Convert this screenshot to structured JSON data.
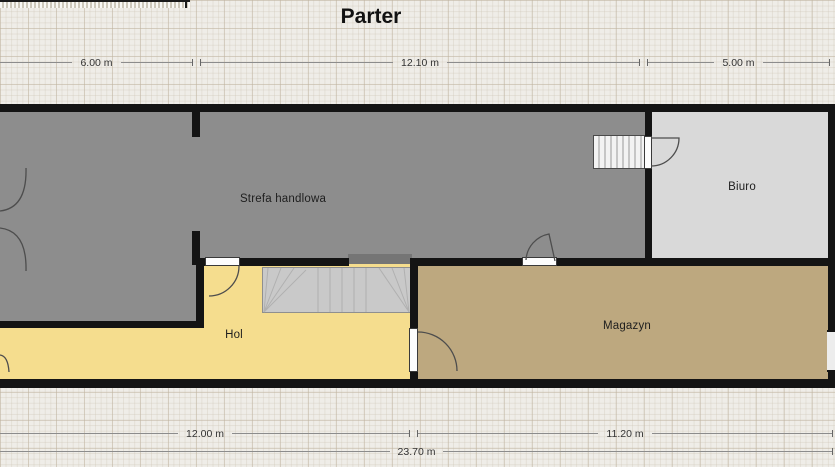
{
  "title": "Parter",
  "rooms": {
    "strefa": {
      "label": "Strefa handlowa",
      "color": "#8d8d8d"
    },
    "biuro": {
      "label": "Biuro",
      "color": "#d9d9d9"
    },
    "hol": {
      "label": "Hol",
      "color": "#f5dd8e"
    },
    "magazyn": {
      "label": "Magazyn",
      "color": "#bda87f"
    }
  },
  "dimensions": {
    "top": [
      {
        "label": "6.00 m"
      },
      {
        "label": "12.10 m"
      },
      {
        "label": "5.00 m"
      }
    ],
    "bottom": [
      {
        "label": "12.00 m"
      },
      {
        "label": "11.20 m"
      }
    ],
    "total": {
      "label": "23.70 m"
    }
  },
  "colors": {
    "wall": "#141414",
    "background": "#efede8",
    "stairs": "#c9c9c9",
    "dimension_line": "#8c8c8c"
  }
}
